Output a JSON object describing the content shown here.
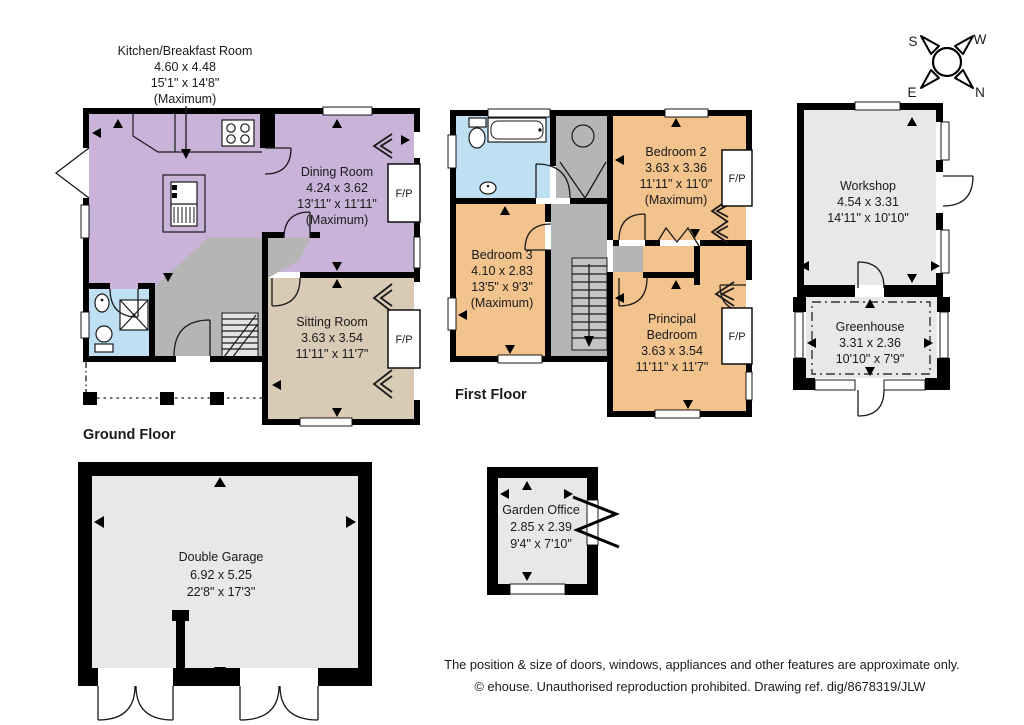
{
  "labels": {
    "ground_floor": "Ground Floor",
    "first_floor": "First Floor",
    "fireplace": "F/P"
  },
  "compass": {
    "s": "S",
    "w": "W",
    "e": "E",
    "n": "N"
  },
  "rooms": {
    "kitchen": {
      "name": "Kitchen/Breakfast Room",
      "metric": "4.60 x 4.48",
      "imperial": "15'1\" x 14'8\"",
      "note": "(Maximum)"
    },
    "dining": {
      "name": "Dining Room",
      "metric": "4.24 x 3.62",
      "imperial": "13'11\" x 11'11\"",
      "note": "(Maximum)"
    },
    "sitting": {
      "name": "Sitting Room",
      "metric": "3.63 x 3.54",
      "imperial": "11'11\" x 11'7\""
    },
    "bedroom2": {
      "name": "Bedroom 2",
      "metric": "3.63 x 3.36",
      "imperial": "11'11\" x 11'0\"",
      "note": "(Maximum)"
    },
    "bedroom3": {
      "name": "Bedroom 3",
      "metric": "4.10 x 2.83",
      "imperial": "13'5\" x 9'3\"",
      "note": "(Maximum)"
    },
    "principal": {
      "name1": "Principal",
      "name2": "Bedroom",
      "metric": "3.63 x 3.54",
      "imperial": "11'11\" x 11'7\""
    },
    "workshop": {
      "name": "Workshop",
      "metric": "4.54 x 3.31",
      "imperial": "14'11\" x 10'10\""
    },
    "greenhouse": {
      "name": "Greenhouse",
      "metric": "3.31 x 2.36",
      "imperial": "10'10\" x 7'9\""
    },
    "garage": {
      "name": "Double Garage",
      "metric": "6.92 x 5.25",
      "imperial": "22'8\" x 17'3\""
    },
    "office": {
      "name": "Garden Office",
      "metric": "2.85 x 2.39",
      "imperial": "9'4\" x 7'10\""
    }
  },
  "footer": {
    "line1": "The position & size of doors, windows, appliances and other features are approximate only.",
    "line2": "© ehouse. Unauthorised reproduction prohibited. Drawing ref. dig/8678319/JLW"
  },
  "colors": {
    "kitchen_dining": "#c9b3d8",
    "bedrooms": "#f2c38c",
    "bathrooms": "#bfe0f3",
    "sitting": "#d8cab4",
    "hall": "#b5b5b5",
    "outbuilding": "#e8e8e8",
    "walls": "#000000"
  }
}
